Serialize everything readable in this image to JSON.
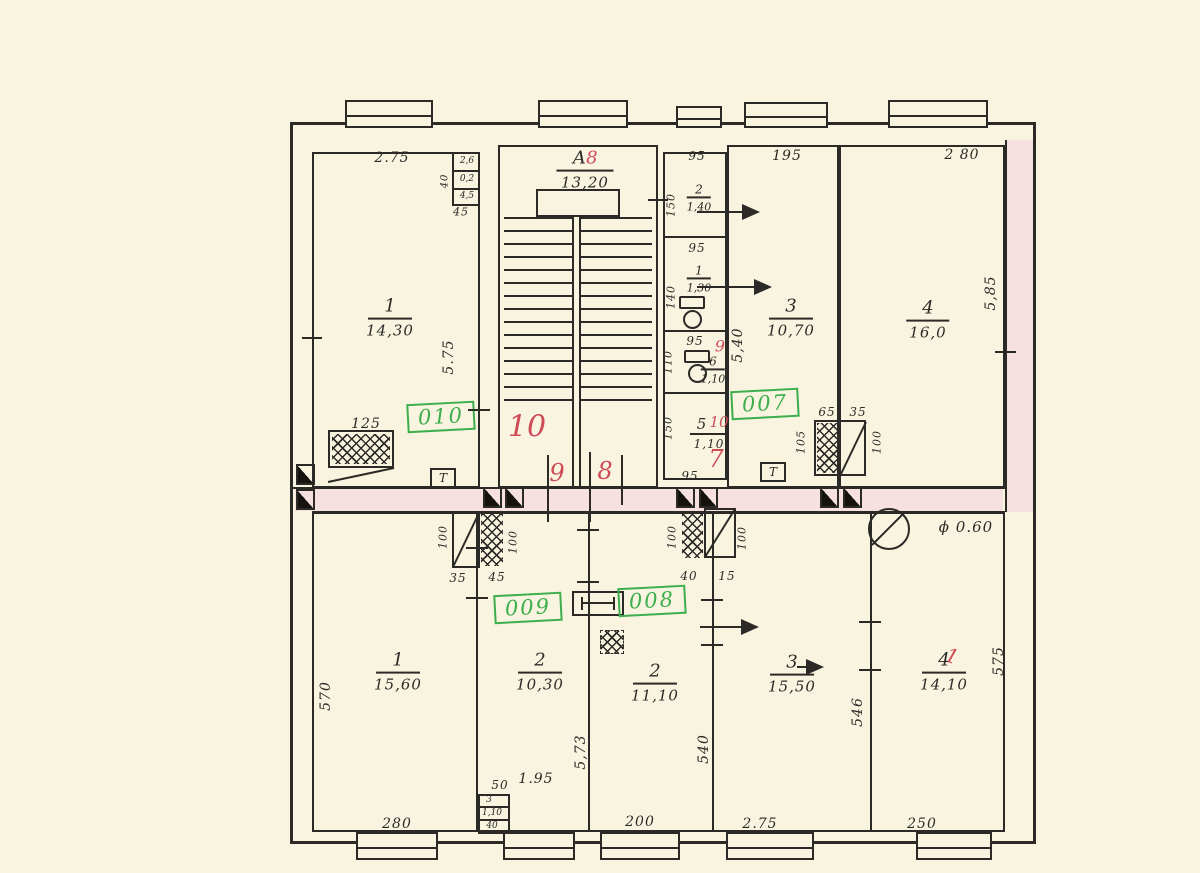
{
  "colors": {
    "paper": "#f8f4e0",
    "ink": "#2b2a26",
    "red": "#cf4b58",
    "green": "#3cae4c",
    "pink": "#f6e0e0"
  },
  "stair": {
    "letter": "А",
    "red_number": "8",
    "area": "13,20"
  },
  "stamps": {
    "apt_010": "010",
    "apt_007": "007",
    "apt_009": "009",
    "apt_008": "008"
  },
  "red_marks": {
    "corridor_big": "10",
    "corridor_9": "9",
    "corridor_8": "8",
    "bath_9": "9",
    "bath_10": "10",
    "bath_7": "7",
    "room4_overlay": "1"
  },
  "rooms": {
    "top_1": {
      "num": "1",
      "area": "14,30"
    },
    "top_3": {
      "num": "3",
      "area": "10,70"
    },
    "top_4": {
      "num": "4",
      "area": "16,0"
    },
    "wc_2": {
      "num": "2",
      "area": "1,40"
    },
    "wc_1": {
      "num": "1",
      "area": "1,30"
    },
    "wc_6": {
      "num": "6",
      "area": "1,10"
    },
    "wc_5": {
      "num": "5",
      "area": "1,10"
    },
    "bot_1": {
      "num": "1",
      "area": "15,60"
    },
    "bot_2": {
      "num": "2",
      "area": "10,30"
    },
    "bot_2c": {
      "num": "2",
      "area": "11,10"
    },
    "bot_3": {
      "num": "3",
      "area": "15,50"
    },
    "bot_4": {
      "num": "4",
      "area": "14,10"
    }
  },
  "dims": {
    "top_275": "2.75",
    "top_195": "195",
    "top_280": "2 80",
    "n95": "95",
    "n100": "100",
    "n150": "150",
    "n140": "140",
    "n110": "110",
    "n125": "125",
    "n35": "35",
    "n45": "45",
    "n40": "40",
    "n15": "15",
    "n50": "50",
    "n65": "65",
    "n105": "105",
    "v575": "5.75",
    "v540": "5,40",
    "v585": "5,85",
    "v570": "570",
    "v573": "5,73",
    "v540b": "540",
    "v546": "546",
    "v575b": "575",
    "b280": "280",
    "b200": "200",
    "b275": "2.75",
    "b250": "250",
    "d195": "1.95",
    "shaft_26": "2,6",
    "shaft_02": "0,2",
    "shaft_45": "4,5",
    "closet_3": "3",
    "closet_110": "1,10",
    "closet_40": "40",
    "column_dia": "ϕ 0.60"
  },
  "symbols": {
    "t_mark": "Т"
  }
}
